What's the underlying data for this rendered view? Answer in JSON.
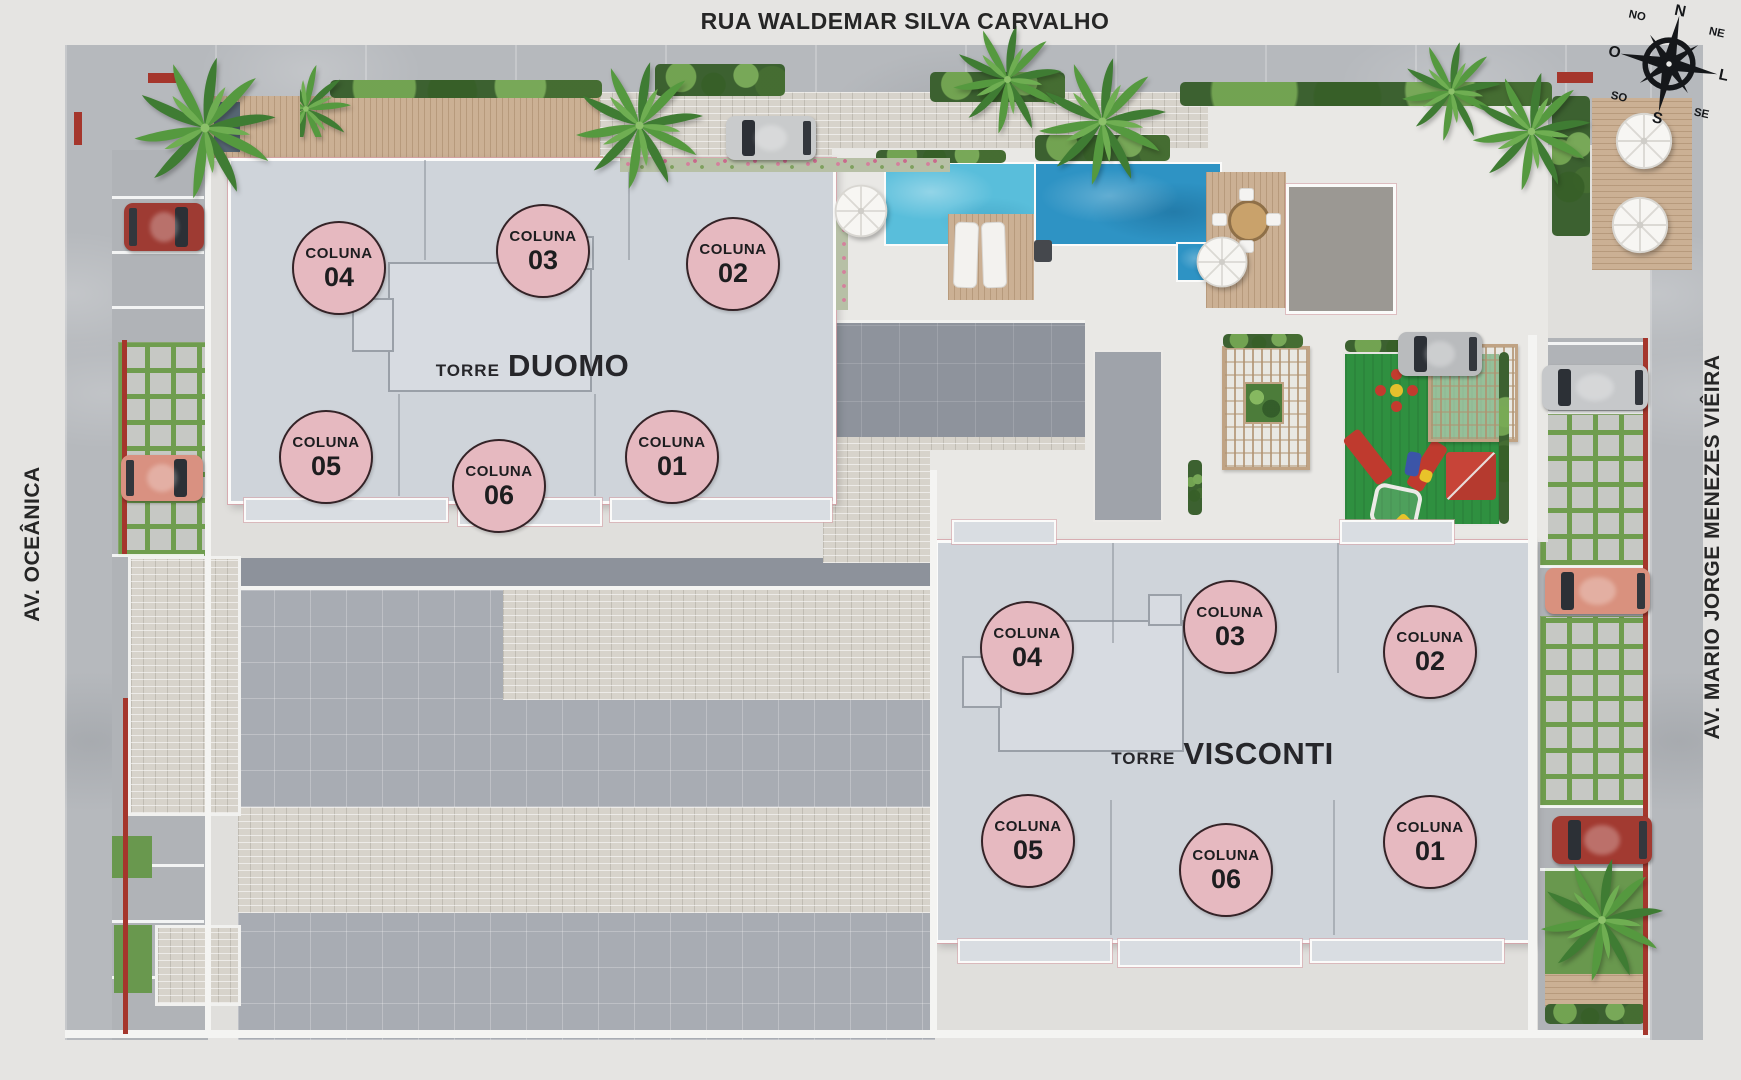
{
  "streets": {
    "top": "RUA WALDEMAR SILVA CARVALHO",
    "left": "AV. OCEÂNICA",
    "right": "AV. MARIO JORGE MENEZES VIÊIRA"
  },
  "compass": {
    "n": "N",
    "ne": "NE",
    "l": "L",
    "se": "SE",
    "s": "S",
    "so": "SO",
    "o": "O",
    "no": "NO"
  },
  "towers": {
    "duomo": {
      "prefix": "TORRE",
      "name": "DUOMO",
      "columns": [
        {
          "label": "COLUNA",
          "number": "04"
        },
        {
          "label": "COLUNA",
          "number": "03"
        },
        {
          "label": "COLUNA",
          "number": "02"
        },
        {
          "label": "COLUNA",
          "number": "05"
        },
        {
          "label": "COLUNA",
          "number": "06"
        },
        {
          "label": "COLUNA",
          "number": "01"
        }
      ]
    },
    "visconti": {
      "prefix": "TORRE",
      "name": "VISCONTI",
      "columns": [
        {
          "label": "COLUNA",
          "number": "04"
        },
        {
          "label": "COLUNA",
          "number": "03"
        },
        {
          "label": "COLUNA",
          "number": "02"
        },
        {
          "label": "COLUNA",
          "number": "05"
        },
        {
          "label": "COLUNA",
          "number": "06"
        },
        {
          "label": "COLUNA",
          "number": "01"
        }
      ]
    }
  },
  "legend_colors": {
    "column_marker": "#e6b9c0",
    "pool_light": "#59bedb",
    "pool_dark": "#2e93c4",
    "playground_green": "#2f9040",
    "accent_red": "#a5362c"
  }
}
